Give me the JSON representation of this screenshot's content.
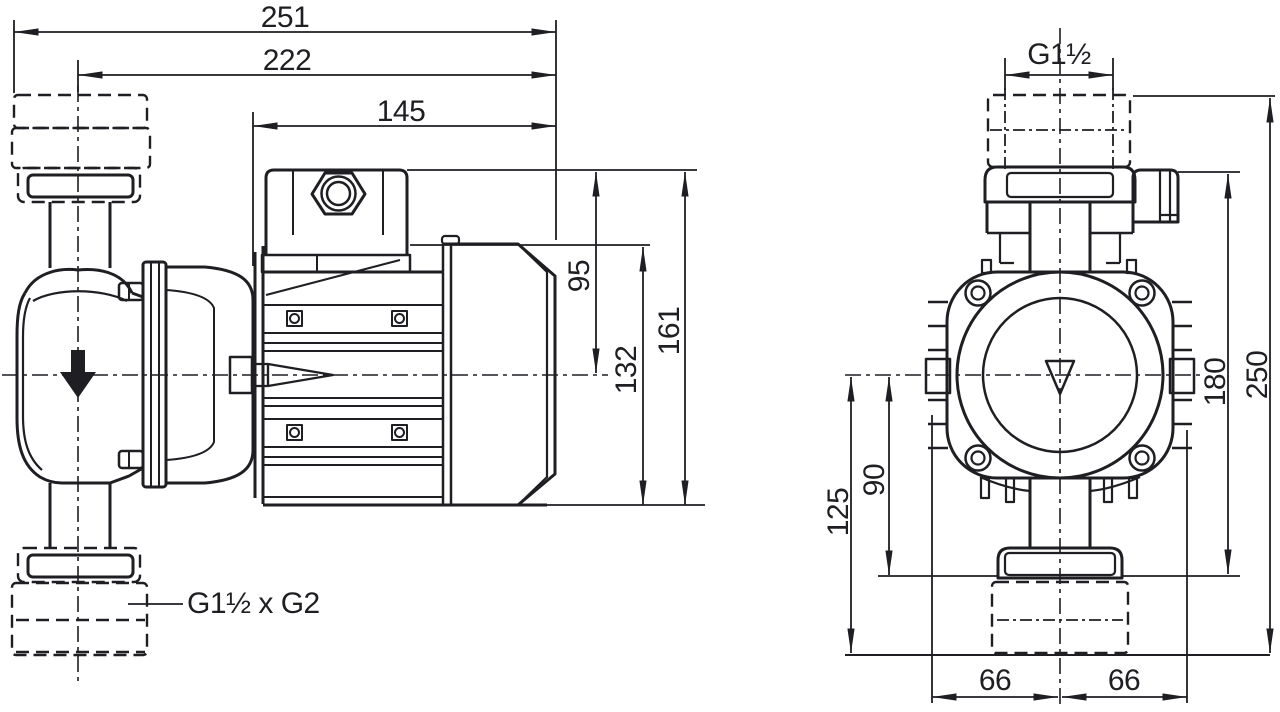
{
  "colors": {
    "line": "#1e1e23",
    "background": "#ffffff"
  },
  "side_view": {
    "dim_overall_length": "251",
    "dim_length_from_pipe_axis": "222",
    "dim_motor_length": "145",
    "dim_axis_to_top": "95",
    "dim_motor_height": "132",
    "dim_total_height": "161",
    "connection_label": "G1½ x G2"
  },
  "front_view": {
    "dim_thread": "G1½",
    "dim_overall_height": "250",
    "dim_top_to_foot": "180",
    "dim_axis_to_foot": "90",
    "dim_axis_to_bottom": "125",
    "dim_half_width_left": "66",
    "dim_half_width_right": "66"
  }
}
